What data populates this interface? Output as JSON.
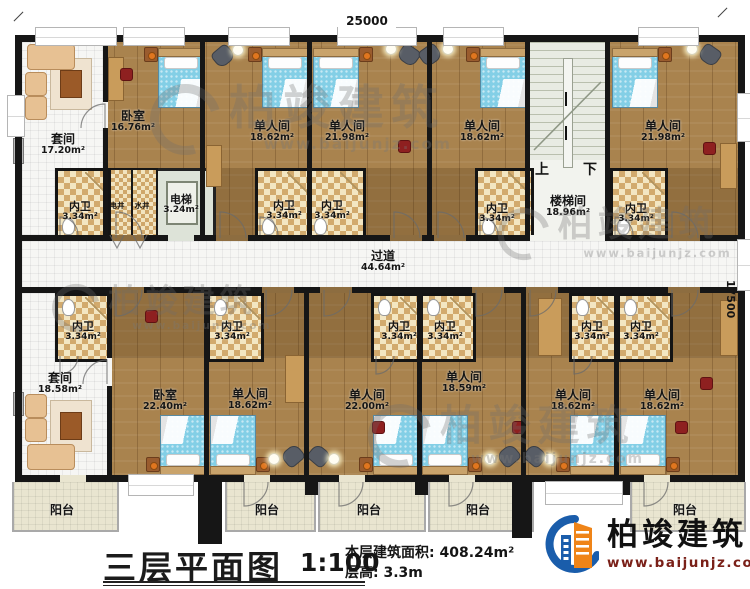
{
  "plan": {
    "dim_width": "25000",
    "dim_height": "17500",
    "corridor": {
      "name": "过道",
      "area": "44.64m²"
    },
    "stairwell": {
      "name": "楼梯间",
      "area": "18.96m²"
    },
    "stair_up": "上",
    "stair_down": "下",
    "elevator": {
      "name": "电梯",
      "area": "3.24m²"
    },
    "elec_shaft": "电井",
    "water_shaft": "水井",
    "bath": {
      "name": "内卫",
      "area": "3.34m²"
    },
    "balcony": "阳台",
    "rooms_top": {
      "suite": {
        "name": "套间",
        "area": "17.20m²"
      },
      "bedroom": {
        "name": "卧室",
        "area": "16.76m²"
      },
      "single1": {
        "name": "单人间",
        "area": "18.62m²"
      },
      "single2": {
        "name": "单人间",
        "area": "21.98m²"
      },
      "single3": {
        "name": "单人间",
        "area": "18.62m²"
      },
      "single4": {
        "name": "单人间",
        "area": "21.98m²"
      }
    },
    "rooms_bottom": {
      "suite": {
        "name": "套间",
        "area": "18.58m²"
      },
      "bedroom": {
        "name": "卧室",
        "area": "22.40m²"
      },
      "single1": {
        "name": "单人间",
        "area": "18.62m²"
      },
      "single2": {
        "name": "单人间",
        "area": "22.00m²"
      },
      "single3": {
        "name": "单人间",
        "area": "18.59m²"
      },
      "single4": {
        "name": "单人间",
        "area": "18.62m²"
      },
      "single5": {
        "name": "单人间",
        "area": "18.62m²"
      }
    }
  },
  "title_block": {
    "title": "三层平面图",
    "scale": "1:100",
    "floor_area": "本层建筑面积: 408.24m²",
    "floor_height": "层高: 3.3m"
  },
  "branding": {
    "company": "柏竣建筑",
    "website": "www.baijunjz.com"
  },
  "colors": {
    "wall": "#161616",
    "wood": "#a9834e",
    "bath_checker": "#d2aa6d",
    "bed": "#83cfe6",
    "logo_blue": "#1a5dab",
    "logo_orange": "#ef8418",
    "website_red": "#7a2018"
  }
}
